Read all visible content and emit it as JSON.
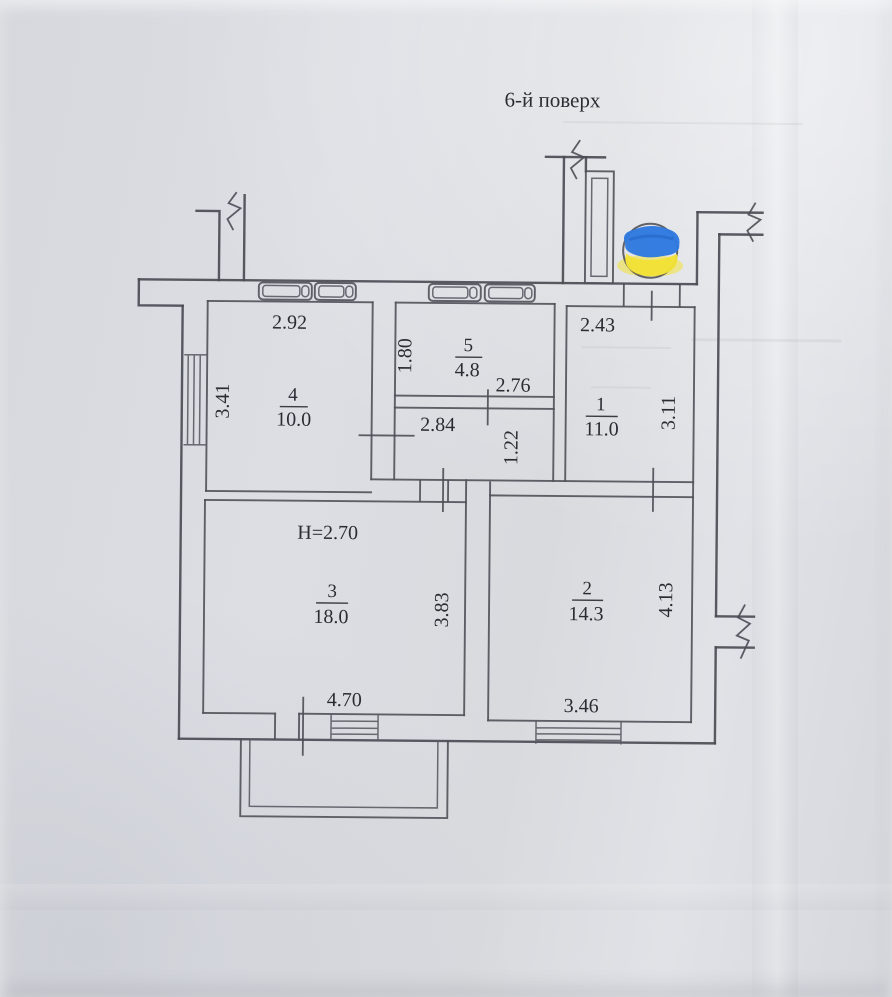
{
  "header": {
    "title": "6-й поверх"
  },
  "rooms": {
    "r1": {
      "num": "1",
      "area": "11.0",
      "w": "2.43",
      "h": "3.11"
    },
    "r2": {
      "num": "2",
      "area": "14.3",
      "w": "3.46",
      "h": "4.13"
    },
    "r3": {
      "num": "3",
      "area": "18.0",
      "w": "4.70",
      "h": "3.83",
      "ceiling": "H=2.70"
    },
    "r4": {
      "num": "4",
      "area": "10.0",
      "w": "2.92",
      "h": "3.41"
    },
    "r5": {
      "num": "5",
      "area": "4.8",
      "w": "2.76",
      "h": "1.80"
    }
  },
  "hall": {
    "w": "2.84",
    "h": "1.22"
  },
  "colors": {
    "paper": "#d9dbe1",
    "ink": "#4b4c55",
    "text": "#2b2c33",
    "flag_blue": "#2e79df",
    "flag_yellow": "#f2e136"
  }
}
